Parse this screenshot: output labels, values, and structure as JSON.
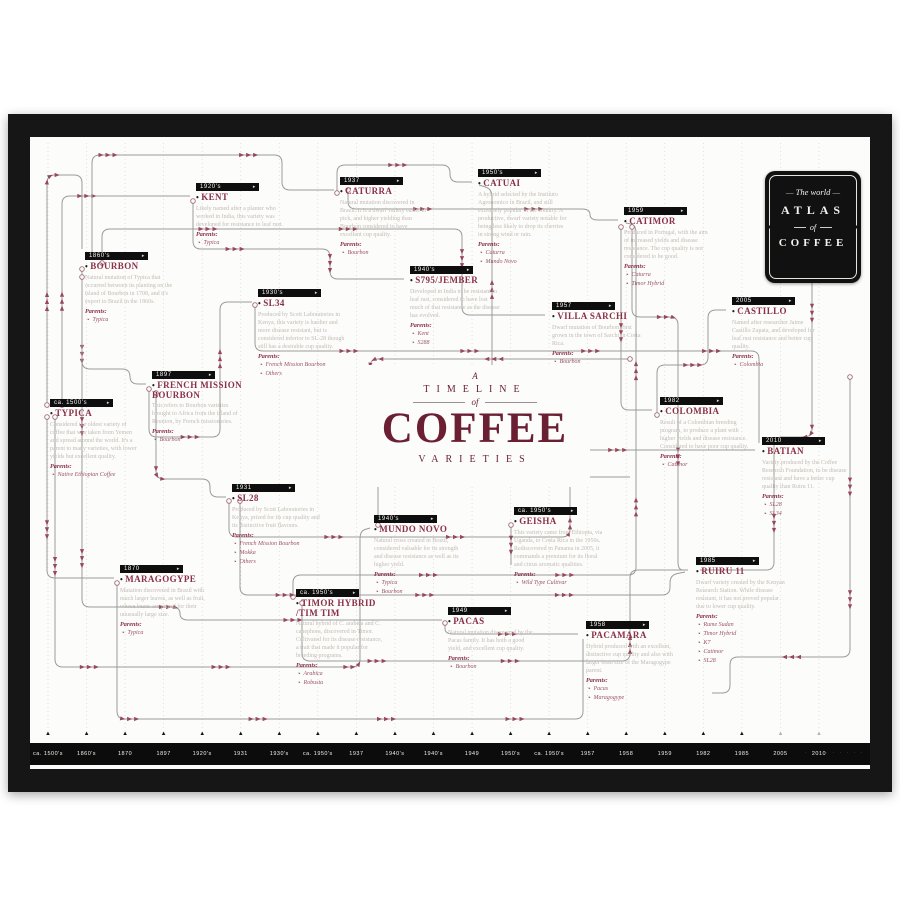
{
  "poster": {
    "logo": {
      "line1": "The world",
      "line2": "ATLAS",
      "of": "of",
      "line4": "COFFEE"
    },
    "title": {
      "pre": "A",
      "line1": "TIMELINE",
      "of": "of",
      "main": "COFFEE",
      "sub": "VARIETIES"
    },
    "colors": {
      "frame": "#161616",
      "paper": "#fcfcfa",
      "variety_name": "#8a3049",
      "title_maroon": "#6b1f33",
      "description_text": "#c2bcb4",
      "line": "#9b9b9b",
      "arrow": "#96485c",
      "axis_bar": "#0c0c0c",
      "gridline": "#d9d5d0"
    },
    "axis": {
      "labels": [
        "ca. 1500's",
        "1860's",
        "1870",
        "1897",
        "1920's",
        "1931",
        "1930's",
        "ca. 1950's",
        "1937",
        "1940's",
        "1940's",
        "1949",
        "1950's",
        "ca. 1950's",
        "1957",
        "1958",
        "1959",
        "1982",
        "1985",
        "2005",
        "2010"
      ],
      "muted_last": 2
    },
    "nodes": [
      {
        "id": "typica",
        "year": "ca. 1500's",
        "name": "TYPICA",
        "desc": "Considered the oldest variety of coffee that was taken from Yemen and spread around the world. It's a parent to many varieties, with lower yields but excellent quality.",
        "parents": [
          "Native Ethiopian Coffee"
        ]
      },
      {
        "id": "bourbon",
        "year": "1860's",
        "name": "BOURBON",
        "desc": "Natural mutation of Typica that occurred between its planting on the island of Bourbon in 1708, and it's export to Brazil in the 1860s.",
        "parents": [
          "Typica"
        ]
      },
      {
        "id": "maragogype",
        "year": "1870",
        "name": "MARAGOGYPE",
        "desc": "Mutation discovered in Brazil with much larger leaves, as well as fruit, whose beans are prized for their unusually large size.",
        "parents": [
          "Typica"
        ]
      },
      {
        "id": "french-mission",
        "year": "1897",
        "name": "FRENCH MISSION BOURBON",
        "desc": "This refers to Bourbon varieties brought to Africa from the island of Reunion, by French missionaries.",
        "parents": [
          "Bourbon"
        ]
      },
      {
        "id": "kent",
        "year": "1920's",
        "name": "KENT",
        "desc": "Likely named after a planter who worked in India, this variety was developed for resistance to leaf rust.",
        "parents": [
          "Typica"
        ]
      },
      {
        "id": "sl28",
        "year": "1931",
        "name": "SL28",
        "desc": "Produced by Scott Laboratories in Kenya, prized for its cup quality and its distinctive fruit flavours.",
        "parents": [
          "French Mission Bourbon",
          "Mokka",
          "Others"
        ]
      },
      {
        "id": "sl34",
        "year": "1930's",
        "name": "SL34",
        "desc": "Produced by Scott Laboratories in Kenya, this variety is hardier and more disease resistant, but is considered inferior to SL-28 though still has a desirable cup quality.",
        "parents": [
          "French Mission Bourbon",
          "Others"
        ]
      },
      {
        "id": "timor-hybrid",
        "year": "ca. 1950's",
        "name": "TIMOR HYBRID /TIM TIM",
        "desc": "Natural hybrid of C. arabica and C. canephora, discovered in Timor. Cultivated for its disease resistance, a trait that made it popular for breeding programs.",
        "parents": [
          "Arabica",
          "Robusta"
        ]
      },
      {
        "id": "caturra",
        "year": "1937",
        "name": "CATURRA",
        "desc": "Natural mutation discovered in Brazil. It is a dwarf variety easier to pick, and higher yielding than Bourbon considered to have excellent cup quality.",
        "parents": [
          "Bourbon"
        ]
      },
      {
        "id": "mundo-novo",
        "year": "1940's",
        "name": "MUNDO NOVO",
        "desc": "Natural cross created in Brazil, considered valuable for its strength and disease resistance as well as its higher yield.",
        "parents": [
          "Typica",
          "Bourbon"
        ]
      },
      {
        "id": "s795-jember",
        "year": "1940's",
        "name": "S795/JEMBER",
        "desc": "Developed in India to be resistant to leaf rust, considered to have lost much of that resistance as the disease has evolved.",
        "parents": [
          "Kent",
          "S288"
        ]
      },
      {
        "id": "pacas",
        "year": "1949",
        "name": "PACAS",
        "desc": "Natural mutation discovered by the Pacas family. It has both a good yield, and excellent cup quality.",
        "parents": [
          "Bourbon"
        ]
      },
      {
        "id": "catuai",
        "year": "1950's",
        "name": "CATUAI",
        "desc": "A hybrid selected by the Instituto Agronomico in Brazil, and still extremely popular in the country. A productive, dwarf variety notable for being less likely to drop its cherries in strong wind or rain.",
        "parents": [
          "Caturra",
          "Mundo Novo"
        ]
      },
      {
        "id": "geisha",
        "year": "ca. 1950's",
        "name": "GEISHA",
        "desc": "This variety came from Ethiopia, via Uganda, to Costa Rica in the 1950s. Rediscovered in Panama in 2005, it commands a premium for its floral and citrus aromatic qualities.",
        "parents": [
          "Wild Type Cultivar"
        ]
      },
      {
        "id": "villa-sarchi",
        "year": "1957",
        "name": "VILLA SARCHI",
        "desc": "Dwarf mutation of Bourbon, first grown in the town of Sarchi in Costa Rica.",
        "parents": [
          "Bourbon"
        ]
      },
      {
        "id": "pacamara",
        "year": "1958",
        "name": "PACAMARA",
        "desc": "Hybrid produced with an excellent, distinctive cup quality and also with larger bean size of the Maragogype parent.",
        "parents": [
          "Pacas",
          "Maragogype"
        ]
      },
      {
        "id": "catimor",
        "year": "1959",
        "name": "CATIMOR",
        "desc": "Produced in Portugal, with the aim of increased yields and disease resistance. The cup quality is not considered to be good.",
        "parents": [
          "Caturra",
          "Timor Hybrid"
        ]
      },
      {
        "id": "colombia",
        "year": "1982",
        "name": "COLOMBIA",
        "desc": "Result of a Colombian breeding program, to produce a plant with higher yields and disease resistance. Considered to have poor cup quality.",
        "parents": [
          "Catimor"
        ]
      },
      {
        "id": "ruiru-11",
        "year": "1985",
        "name": "RUIRU 11",
        "desc": "Dwarf variety created by the Kenyan Research Station. While disease resistant, it has not proved popular due to lower cup quality.",
        "parents": [
          "Rume Sudan",
          "Timor Hybrid",
          "K7",
          "Catimor",
          "SL28"
        ]
      },
      {
        "id": "castillo",
        "year": "2005",
        "name": "CASTILLO",
        "desc": "Named after researcher Jaime Castillo Zapata, and developed for leaf rust resistance and better cup quality.",
        "parents": [
          "Colombia"
        ]
      },
      {
        "id": "batian",
        "year": "2010",
        "name": "BATIAN",
        "desc": "Variety produced by the Coffee Research Foundation, to be disease resistant and have a better cup quality than Ruiru 11.",
        "parents": [
          "SL28",
          "SL34"
        ]
      }
    ]
  }
}
